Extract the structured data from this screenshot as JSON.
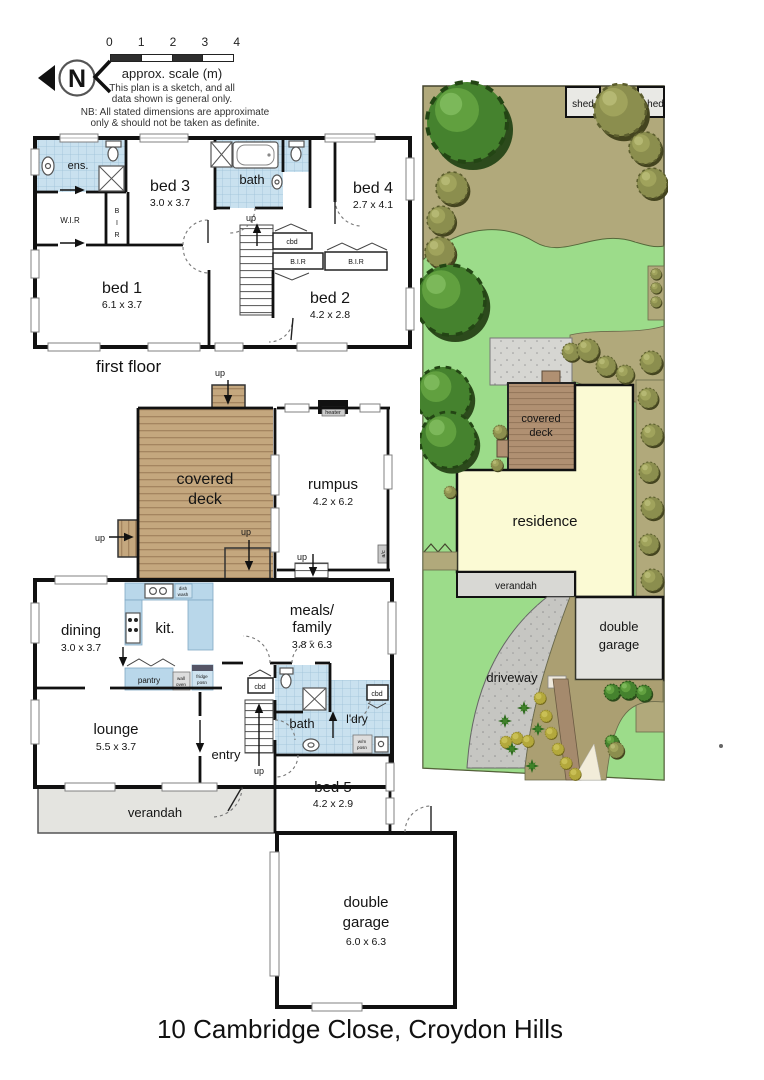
{
  "title": "10 Cambridge Close, Croydon Hills",
  "header": {
    "north_letter": "N",
    "scale_ticks": [
      "0",
      "1",
      "2",
      "3",
      "4"
    ],
    "scale_label": "approx. scale (m)",
    "sketch_note_line1": "This plan is a sketch, and all",
    "sketch_note_line2": "data shown is general only.",
    "nb_line1": "NB: All stated dimensions are approximate",
    "nb_line2": "only & should not be taken as definite."
  },
  "first_floor": {
    "caption": "first floor",
    "bir_letters": [
      "B",
      "I",
      "R"
    ],
    "up": "up",
    "rooms": {
      "ens": {
        "name": "ens."
      },
      "wir": {
        "name": "W.I.R"
      },
      "bed3": {
        "name": "bed 3",
        "dims": "3.0 x 3.7"
      },
      "bath": {
        "name": "bath"
      },
      "bed4": {
        "name": "bed 4",
        "dims": "2.7 x 4.1"
      },
      "cbd": {
        "name": "cbd"
      },
      "bir1": {
        "name": "B.I.R"
      },
      "bir2": {
        "name": "B.I.R"
      },
      "bed1": {
        "name": "bed 1",
        "dims": "6.1 x 3.7"
      },
      "bed2": {
        "name": "bed 2",
        "dims": "4.2 x 2.8"
      }
    }
  },
  "ground_floor": {
    "up": "up",
    "deck": {
      "line1": "covered",
      "line2": "deck"
    },
    "rumpus": {
      "name": "rumpus",
      "dims": "4.2 x 6.2"
    },
    "heater": "heater",
    "ac": "a/c",
    "dining": {
      "name": "dining",
      "dims": "3.0 x 3.7"
    },
    "kitchen": {
      "name": "kit.",
      "dish_line1": "dish",
      "dish_line2": "wash",
      "pantry": "pantry",
      "oven_line1": "wall",
      "oven_line2": "oven",
      "fridge_line1": "fridge",
      "fridge_line2": "posn"
    },
    "meals": {
      "line1": "meals/",
      "line2": "family",
      "dims": "3.8 x 6.3"
    },
    "lounge": {
      "name": "lounge",
      "dims": "5.5 x 3.7"
    },
    "entry": "entry",
    "cbd": "cbd",
    "bath": "bath",
    "laundry": {
      "name": "l'dry",
      "wm_line1": "w/m",
      "wm_line2": "posn",
      "cbd": "cbd"
    },
    "bed5": {
      "name": "bed 5",
      "dims": "4.2 x 2.9"
    },
    "verandah": "verandah",
    "garage": {
      "line1": "double",
      "line2": "garage",
      "dims": "6.0 x 6.3"
    }
  },
  "site_plan": {
    "shed1": "shed",
    "shed2": "shed",
    "deck_line1": "covered",
    "deck_line2": "deck",
    "residence": "residence",
    "verandah": "verandah",
    "garage_line1": "double",
    "garage_line2": "garage",
    "driveway": "driveway"
  },
  "colors": {
    "wood": "#c4a77e",
    "tile_blue": "#c9e1ef",
    "lawn_green": "#9cdc8a",
    "site_tan": "#b1a97b",
    "residence_yellow": "#fbfad4"
  }
}
